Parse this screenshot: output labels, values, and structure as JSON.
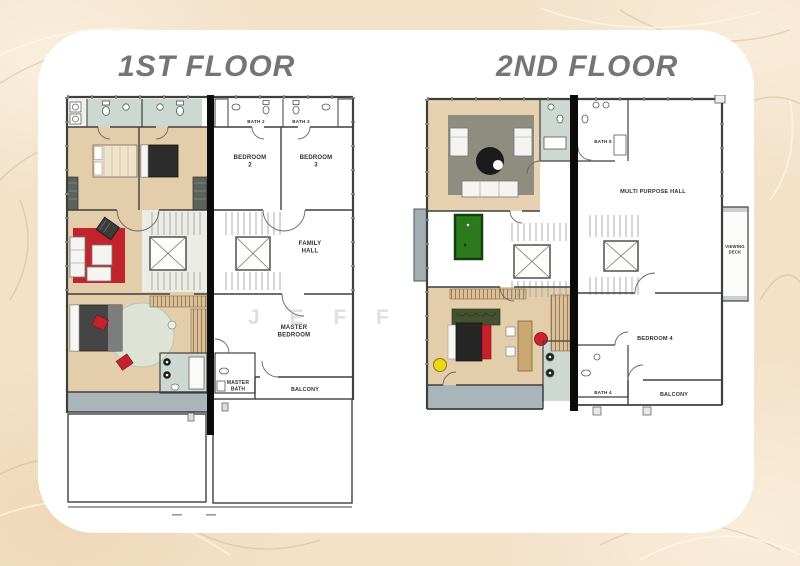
{
  "titles": {
    "floor1": "1ST FLOOR",
    "floor2": "2ND FLOOR"
  },
  "watermark": "J E F F",
  "floor1": {
    "rooms": {
      "bath2": "BATH 2",
      "bath3": "BATH 3",
      "bedroom2": "BEDROOM\n2",
      "bedroom3": "BEDROOM\n3",
      "family_hall": "FAMILY\nHALL",
      "master_bedroom": "MASTER\nBEDROOM",
      "master_bath": "MASTER\nBATH",
      "balcony": "BALCONY"
    }
  },
  "floor2": {
    "rooms": {
      "bath5": "BATH 5",
      "multi_purpose_hall": "MULTI PURPOSE HALL",
      "viewing_deck": "VIEWING\nDECK",
      "bedroom4": "BEDROOM 4",
      "bath4": "BATH 4",
      "balcony": "BALCONY"
    }
  },
  "colors": {
    "background": "#f3e1c8",
    "card": "#ffffff",
    "title_gray": "#757575",
    "wood_floor": "#e3cdab",
    "bath_floor": "#cdd8d2",
    "balcony_floor": "#a9b5b9",
    "sofa_red": "#c2242e",
    "pool_table_green": "#2c791e",
    "stool_yellow": "#f1d616",
    "party_wall": "#0b0b0b"
  }
}
